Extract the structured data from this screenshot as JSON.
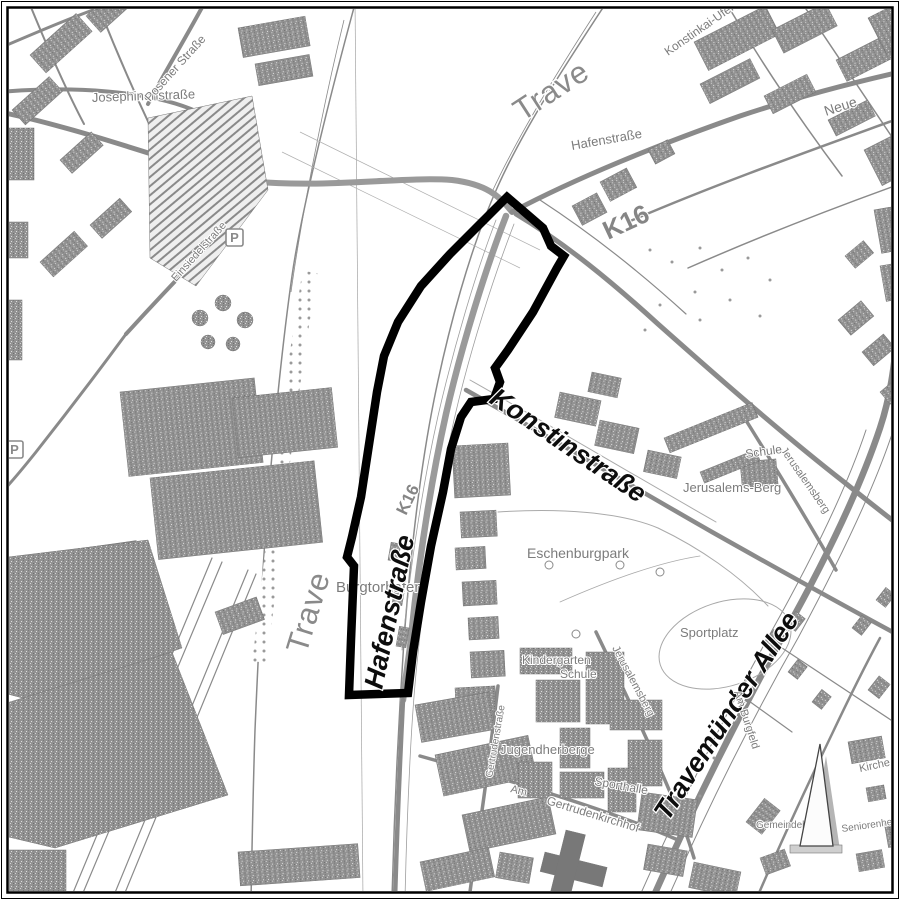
{
  "map": {
    "labels": {
      "trave_top": "Trave",
      "trave_left": "Trave",
      "konstinkai_ufer": "Konstinkai-Ufer",
      "hafenstrasse_small": "Hafenstraße",
      "neue": "Neue",
      "k16_upper": "K16",
      "k16_lower": "K16",
      "josephinenstrasse": "Josephinenstraße",
      "posener_strasse": "Posener Straße",
      "einsiedelstrasse": "Einsiedelstraße",
      "konstinstrasse": "Konstinstraße",
      "hafenstrasse_large": "Hafenstraße",
      "travemuender_allee": "Travemünder Allee",
      "burgtorhafen": "Burgtorhafen",
      "eschenburgpark": "Eschenburgpark",
      "sportplatz": "Sportplatz",
      "schule_north": "Schule",
      "jerusalems_berg": "Jerusalems-Berg",
      "jerusalemsberg_street_upper": "Jerusalemsberg",
      "jerusalemsberg_street_lower": "Jerusalemsberg",
      "kindergarten": "Kindergarten",
      "schule_south": "Schule",
      "jugendherberge": "Jugendherberge",
      "sporthalle": "Sporthalle",
      "am": "Am",
      "gertrudenkirchhof": "Gertrudenkirchhof",
      "gertrudenstrasse": "Gertrudenstraße",
      "am_burgfeld": "Am Burgfeld",
      "kirche": "Kirche",
      "seniorenheim": "Seniorenheim",
      "gemeindehaus": "Gemeindehaus",
      "parking_1": "P",
      "parking_2": "P"
    },
    "icons": {
      "north_arrow": "north-arrow",
      "parking": "parking-sign"
    },
    "colors": {
      "line_gray": "#8a8a8a",
      "building_gray": "#919191",
      "boundary_black": "#000000",
      "label_gray": "#7c7c7c",
      "label_black": "#0d0d0d"
    }
  }
}
